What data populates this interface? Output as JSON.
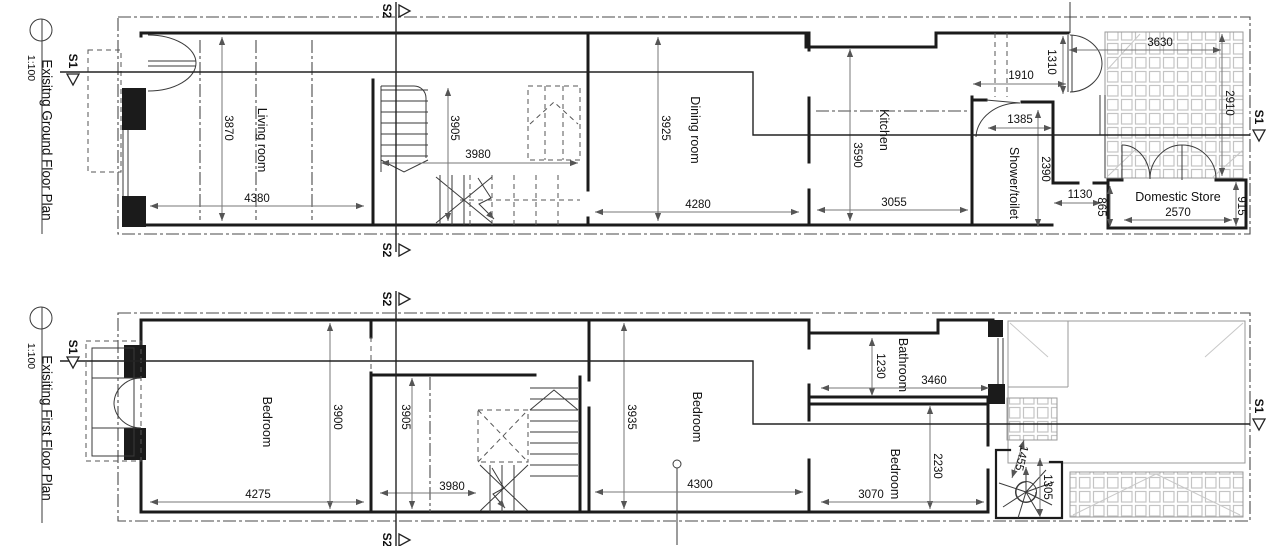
{
  "drawing": {
    "sections": {
      "s1": "S1",
      "s2": "S2"
    },
    "ground": {
      "title": "Exisitng Ground Floor Plan",
      "scale": "1:100",
      "rooms": {
        "living": "Living room",
        "dining": "Dining room",
        "kitchen": "Kitchen",
        "shower": "Shower/toilet",
        "store": "Domestic Store"
      },
      "dims": {
        "living_h": "3870",
        "living_w": "4380",
        "hall_h": "3905",
        "hall_w": "3980",
        "dining_h": "3925",
        "dining_w": "4280",
        "kitchen_h": "3590",
        "kitchen_w": "3055",
        "rear_w": "1910",
        "rear_h": "1310",
        "shower_w": "1385",
        "shower_h": "2390",
        "lobby_w": "1130",
        "lobby_h": "865",
        "patio_w": "3630",
        "patio_h": "2910",
        "store_w": "2570",
        "store_h": "915"
      }
    },
    "first": {
      "title": "Exisiting First Floor Plan",
      "scale": "1:100",
      "rooms": {
        "bedroom_front": "Bedroom",
        "bedroom_middle": "Bedroom",
        "bedroom_rear": "Bedroom",
        "bathroom": "Bathroom"
      },
      "dims": {
        "bedroom_front_h": "3900",
        "bedroom_front_w": "4275",
        "hall_h": "3905",
        "hall_w": "3980",
        "bedroom_middle_h": "3935",
        "bedroom_middle_w": "4300",
        "bathroom_h": "1230",
        "bathroom_w": "3460",
        "bedroom_rear_h": "2230",
        "bedroom_rear_w": "3070",
        "spiral_w": "1455",
        "spiral_h": "1305"
      }
    }
  }
}
